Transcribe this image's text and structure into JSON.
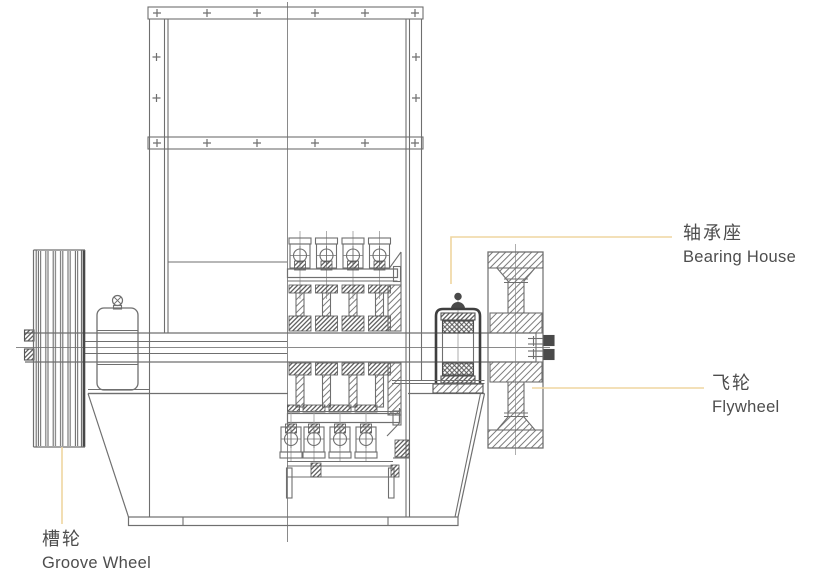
{
  "labels": {
    "bearing_house": {
      "zh": "轴承座",
      "en": "Bearing House"
    },
    "flywheel": {
      "zh": "飞轮",
      "en": "Flywheel"
    },
    "groove_wheel": {
      "zh": "槽轮",
      "en": "Groove Wheel"
    }
  },
  "colors": {
    "leader": "#EFD5A0",
    "line": "#6F6F6F",
    "line_dark": "#3F3F3F",
    "text": "#4D4D4D",
    "background": "#FFFFFF"
  }
}
